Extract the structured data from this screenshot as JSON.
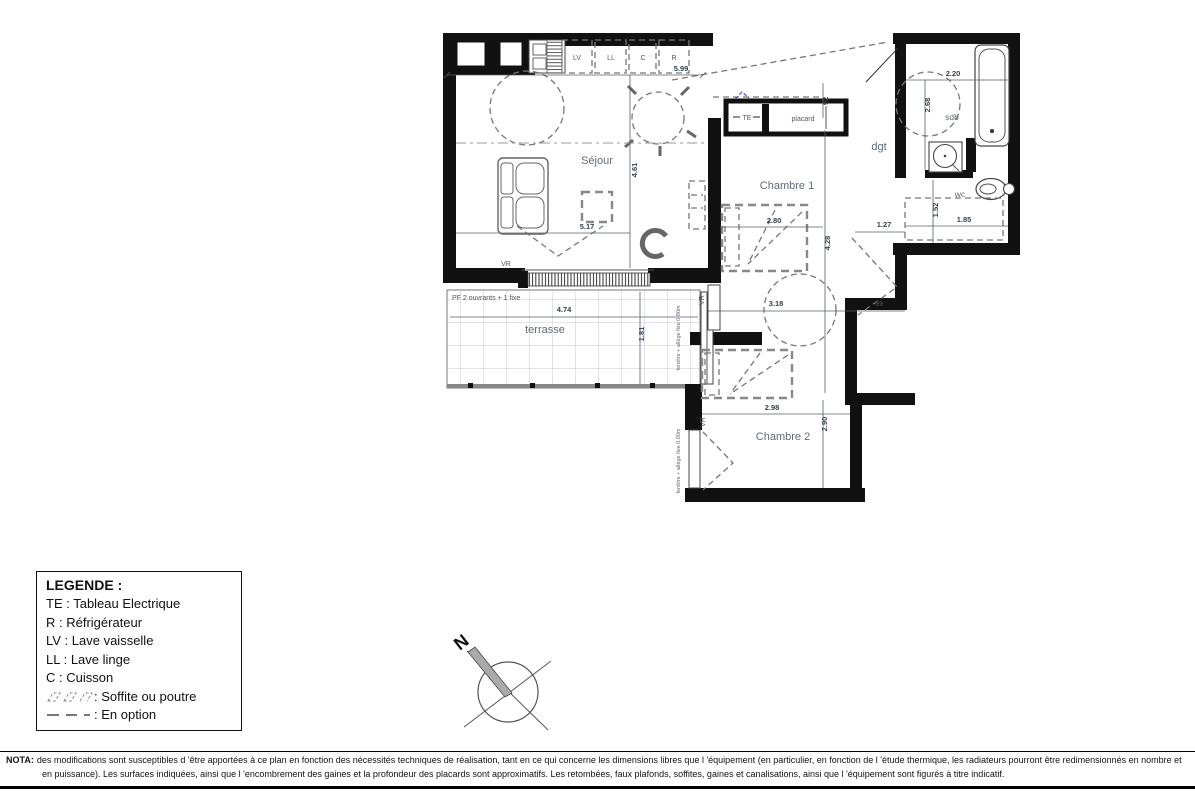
{
  "plan": {
    "rooms": {
      "sejour": "Séjour",
      "chambre1": "Chambre 1",
      "chambre2": "Chambre 2",
      "terrasse": "terrasse",
      "sdb": "sdb",
      "wc": "wc",
      "dgt": "dgt",
      "placard": "placard"
    },
    "appliances": {
      "lv": "LV",
      "ll": "LL",
      "c": "C",
      "r": "R",
      "te": "TE"
    },
    "dimensions": {
      "kitchen_top_width": "5.99",
      "sejour_height": "4.61",
      "sejour_width": "5.17",
      "entry_depth": "92",
      "chambre1_width": "2.80",
      "chambre1_height": "4.28",
      "hall_width": "1.27",
      "chambre1_lower_width": "3.18",
      "recess_width": "99",
      "chambre2_width": "2.98",
      "chambre2_height": "2.90",
      "sdb_width": "2.20",
      "sdb_height": "2.68",
      "wc_width": "1.85",
      "wc_height": "1.52",
      "terrasse_width": "4.74",
      "terrasse_height": "1.81"
    },
    "annotations": {
      "vr": "VR",
      "pf_bay": "PF 2 ouvrants + 1 fixe",
      "fixed_window": "fenêtre + allège fixe 0.80m"
    }
  },
  "legend": {
    "title": "LEGENDE :",
    "items": [
      "TE : Tableau Electrique",
      "R : Réfrigérateur",
      "LV : Lave vaisselle",
      "LL : Lave linge",
      "C : Cuisson"
    ],
    "soffite": ": Soffite ou poutre",
    "option": ": En option"
  },
  "compass": {
    "north": "N"
  },
  "nota": {
    "label": "NOTA:",
    "text": "des modifications sont susceptibles d 'être apportées à ce plan en fonction des nécessités techniques de réalisation, tant en ce qui concerne les dimensions libres que l 'équipement (en particulier, en fonction de l 'étude thermique, les radiateurs pourront être redimensionnés en nombre et en puissance). Les surfaces indiquées, ainsi que l 'encombrement des gaines et la profondeur des placards sont approximatifs. Les retombées, faux plafonds, soffites, gaines et canalisations, ainsi que l 'équipement sont figurés à titre indicatif."
  },
  "colors": {
    "wall": "#111111",
    "room_label": "#5f6b78",
    "dimension_text": "#33424f",
    "accent_blue": "#4455ee"
  }
}
